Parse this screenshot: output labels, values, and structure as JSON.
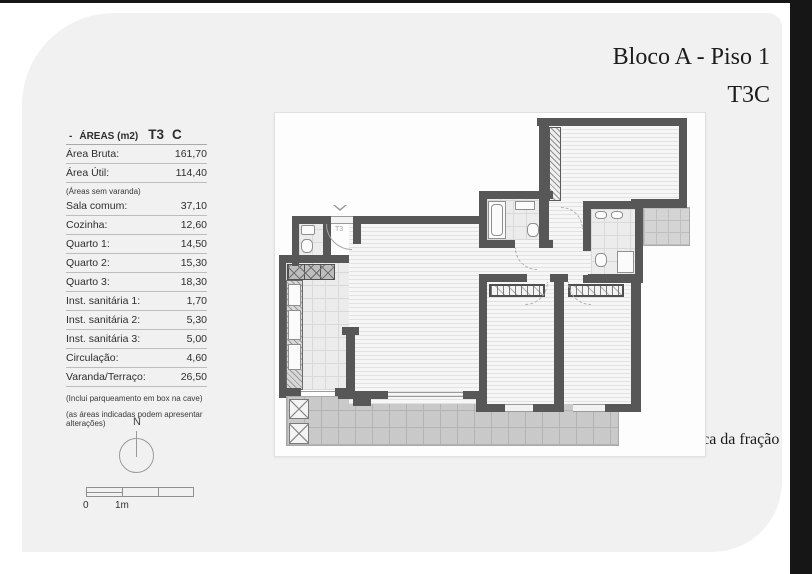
{
  "page": {
    "title_line1": "Bloco A - Piso 1",
    "title_line2": "T3C",
    "caption": "Planta técnica da fração"
  },
  "areas_table": {
    "header": {
      "dash": "-",
      "label": "ÁREAS (m2)",
      "typology": "T3",
      "fraction": "C"
    },
    "rows": [
      {
        "label": "Área Bruta:",
        "value": "161,70"
      },
      {
        "label": "Área Útil:",
        "value": "114,40"
      },
      {
        "label": "Sala comum:",
        "value": "37,10"
      },
      {
        "label": "Cozinha:",
        "value": "12,60"
      },
      {
        "label": "Quarto 1:",
        "value": "14,50"
      },
      {
        "label": "Quarto 2:",
        "value": "15,30"
      },
      {
        "label": "Quarto 3:",
        "value": "18,30"
      },
      {
        "label": "Inst. sanitária 1:",
        "value": "1,70"
      },
      {
        "label": "Inst. sanitária 2:",
        "value": "5,30"
      },
      {
        "label": "Inst. sanitária 3:",
        "value": "5,00"
      },
      {
        "label": "Circulação:",
        "value": "4,60"
      },
      {
        "label": "Varanda/Terraço:",
        "value": "26,50"
      }
    ],
    "note_after_util": "(Áreas sem varanda)",
    "footnotes": [
      "(Inclui parqueamento em box na cave)",
      "(as áreas indicadas podem apresentar alterações)"
    ]
  },
  "compass": {
    "label": "N"
  },
  "scale_bar": {
    "zero_label": "0",
    "meter_label": "1m"
  },
  "plan": {
    "entry_label": "T3"
  },
  "colors": {
    "wall": "#575757",
    "panel_background": "#f1f1f1",
    "frame_bar": "#161616",
    "terrace_tile": "#c9c9c9",
    "balcony_tile": "#d4d4d4",
    "bath_tile": "#ececec",
    "wood_line": "#e2e2e2"
  }
}
